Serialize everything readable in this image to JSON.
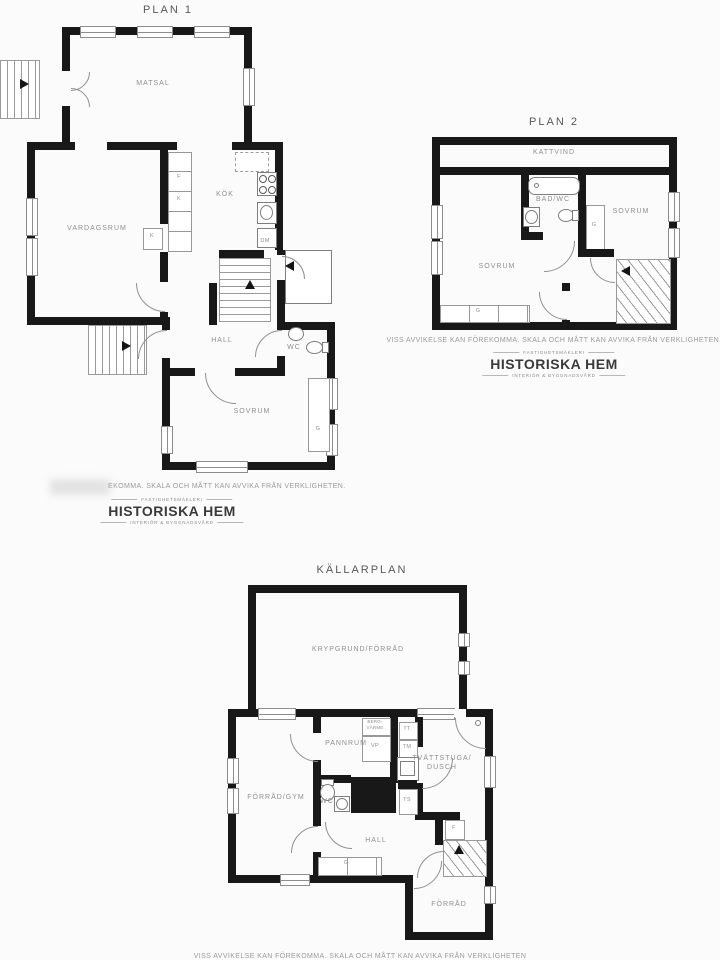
{
  "colors": {
    "wall": "#181818",
    "label": "#8f8f8f",
    "background": "#fbfbfb",
    "logo_text": "#3a3a3a"
  },
  "plan1": {
    "title": "PLAN 1",
    "rooms": {
      "matsal": "MATSAL",
      "vardagsrum": "VARDAGSRUM",
      "kok": "KÖK",
      "hall": "HALL",
      "wc": "WC",
      "sovrum": "SOVRUM"
    },
    "fixtures": {
      "f": "F",
      "k_upper": "K",
      "k_lower": "K",
      "dm": "DM",
      "g": "G"
    },
    "disclaimer_visible": "EKOMMA. SKALA OCH MÅTT KAN AVVIKA FRÅN VERKLIGHETEN."
  },
  "plan2": {
    "title": "PLAN 2",
    "rooms": {
      "kattvind": "KATTVIND",
      "bad_wc": "BAD/WC",
      "sovrum_right": "SOVRUM",
      "sovrum_left": "SOVRUM"
    },
    "fixtures": {
      "g_right": "G",
      "g_left": "G"
    },
    "disclaimer": "VISS AVVIKELSE KAN FÖREKOMMA. SKALA OCH MÅTT KAN AVVIKA FRÅN VERKLIGHETEN."
  },
  "kallarplan": {
    "title": "KÄLLARPLAN",
    "rooms": {
      "krypgrund": "KRYPGRUND/FÖRRÅD",
      "pannrum": "PANNRUM",
      "tvattstuga_line1": "TVÄTTSTUGA/",
      "tvattstuga_line2": "DUSCH",
      "forrad_gym": "FÖRRÅD/GYM",
      "wc": "WC",
      "hall": "HALL",
      "forrad": "FÖRRÅD"
    },
    "fixtures": {
      "berg_line1": "BERG-",
      "berg_line2": "VÄRME",
      "vp": "VP",
      "tt": "TT",
      "tm": "TM",
      "ts": "TS",
      "f": "F",
      "g": "G"
    },
    "disclaimer_cut": "VISS AVVIKELSE KAN FÖREKOMMA. SKALA OCH MÅTT KAN AVVIKA FRÅN VERKLIGHETEN"
  },
  "logo": {
    "tagline_top": "FASTIGHETSMÄKLERI",
    "name": "HISTORISKA HEM",
    "tagline_bottom": "INTERIÖR & BYGGNADSVÅRD"
  }
}
